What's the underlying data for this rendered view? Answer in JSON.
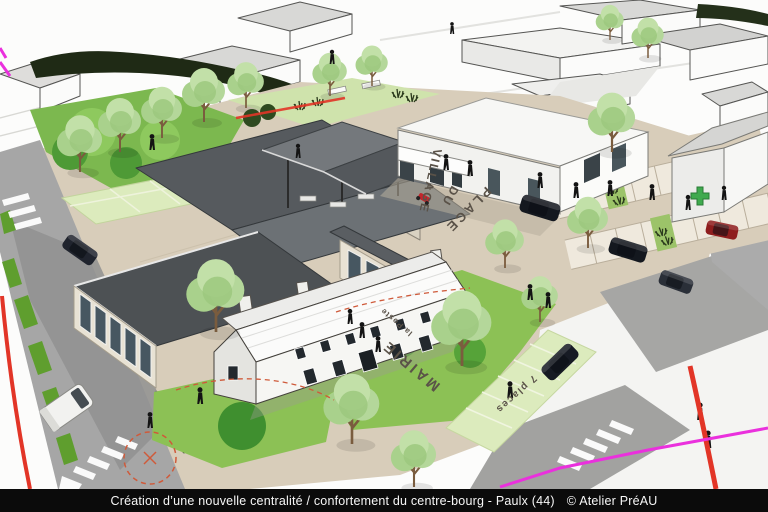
{
  "caption_bar": {
    "title": "Création d’une nouvelle centralité / confortement du centre-bourg - Paulx (44)",
    "credit": "© Atelier PréAU"
  },
  "ground_labels": {
    "place_word1": "PLACE",
    "place_word2": "DU",
    "place_word3": "VILLAGE",
    "town_hall": "MAIRIE",
    "post_office": "la Poste",
    "parking_capacity": "7 places"
  },
  "icons": {
    "pharmacy_cross": "green-cross"
  },
  "colors": {
    "caption_bar_bg": "#0b0b0b",
    "caption_text": "#f7f7f7",
    "site_boundary_red": "#e23527",
    "property_line_magenta": "#ea30dd",
    "path_dashed_red": "#cf5a3a",
    "lawn_green": "#8cc155",
    "lawn_light_green": "#dcebbd",
    "tree_canopy_green": "#b4d79a",
    "plaza_beige": "#d8cdba",
    "road_gray": "#a6a6a6",
    "roof_dark_gray": "#55595d",
    "pharmacy_cross_green": "#3faa4e"
  }
}
